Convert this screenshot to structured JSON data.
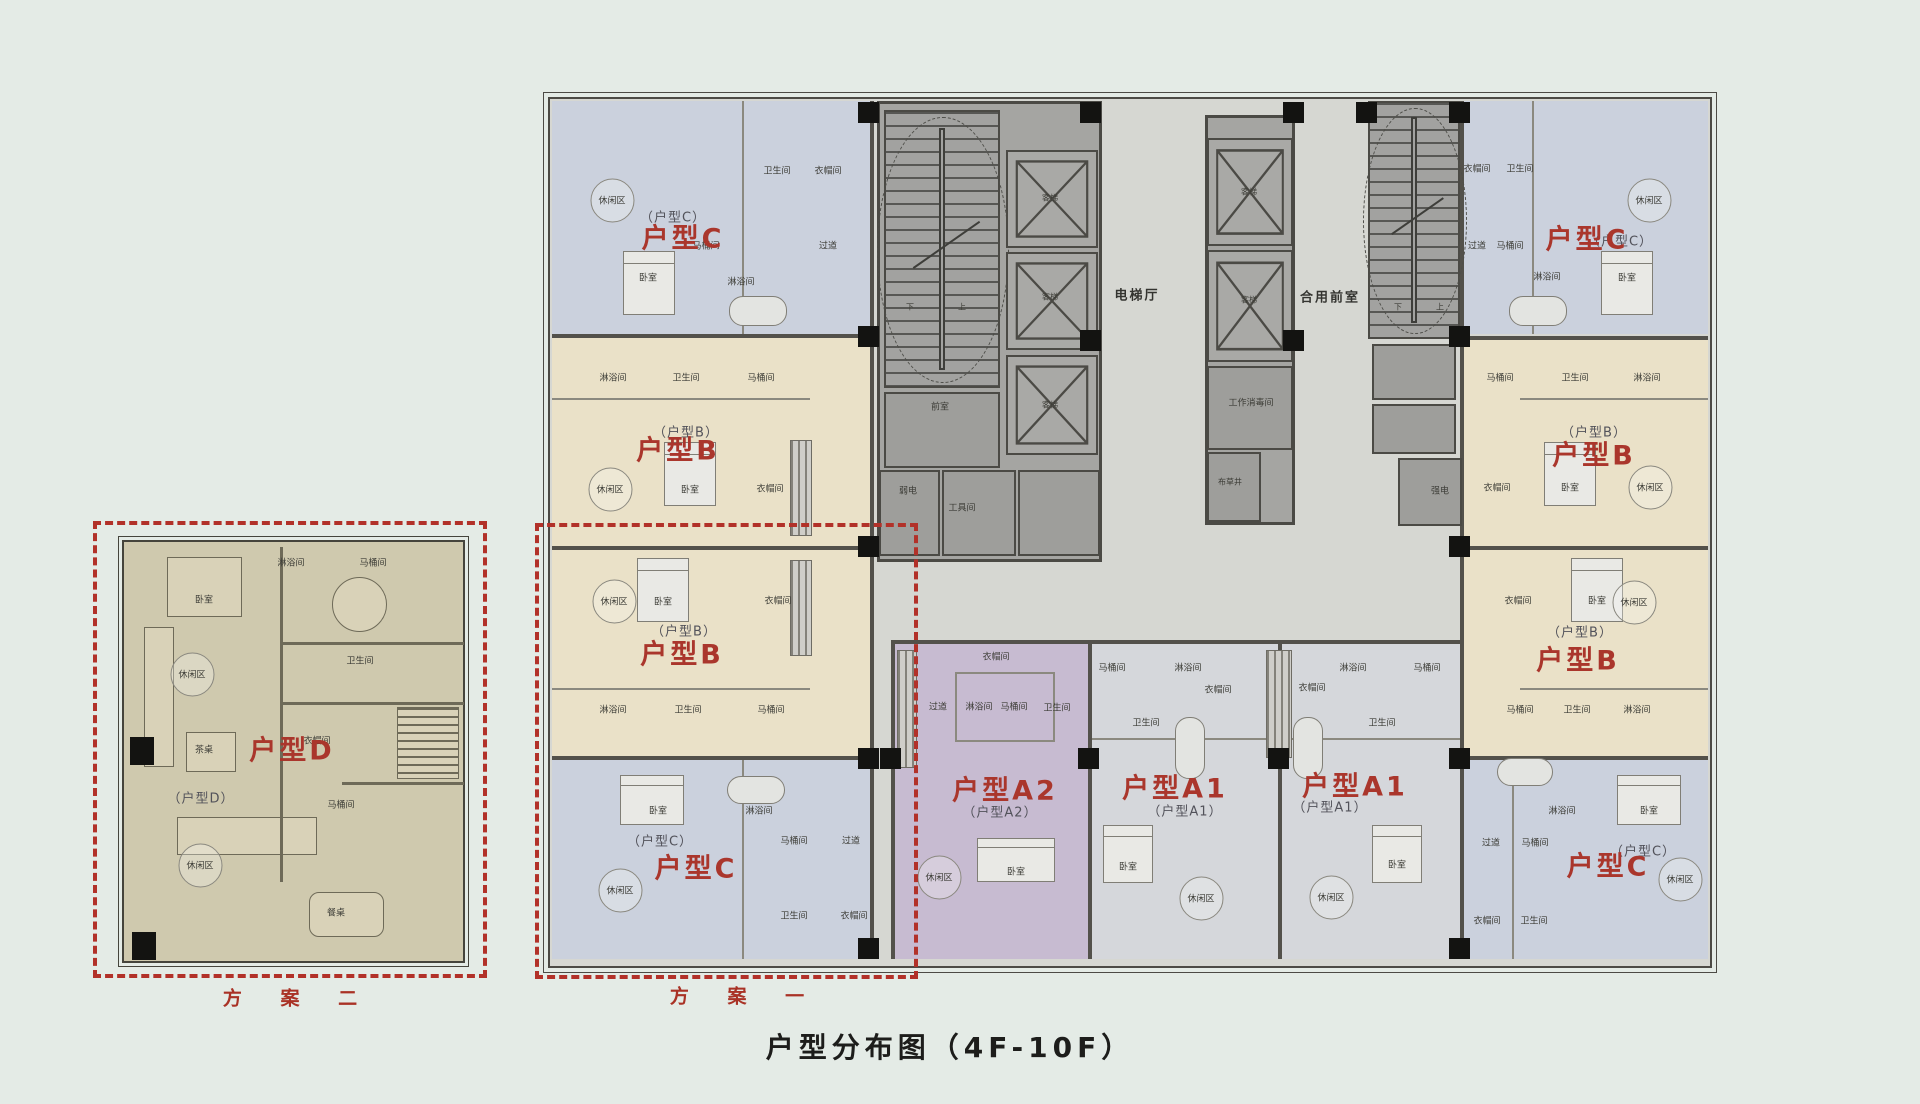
{
  "title": "户型分布图（4F-10F）",
  "schemes": {
    "one": "方 案 一",
    "two": "方 案 二"
  },
  "colors": {
    "canvas_bg": "#e4ebe6",
    "plan_bg": "#d6d7d2",
    "unit_c": "#cbd1dd",
    "unit_b": "#eae1c8",
    "unit_a1": "#d5d7db",
    "unit_a2": "#c7bbd1",
    "unit_d_bg": "#cfc9ae",
    "core_gray": "#a5a5a2",
    "wall": "#53514b",
    "label_red": "#aa362c",
    "dash_red": "#b23129",
    "title_black": "#1d1d1b"
  },
  "unit_labels": [
    {
      "t": "户型C",
      "x": 683,
      "y": 236
    },
    {
      "t": "户型B",
      "x": 678,
      "y": 448
    },
    {
      "t": "户型B",
      "x": 682,
      "y": 652
    },
    {
      "t": "户型C",
      "x": 696,
      "y": 866
    },
    {
      "t": "户型C",
      "x": 1587,
      "y": 237
    },
    {
      "t": "户型B",
      "x": 1594,
      "y": 453
    },
    {
      "t": "户型B",
      "x": 1578,
      "y": 658
    },
    {
      "t": "户型C",
      "x": 1608,
      "y": 864
    },
    {
      "t": "户型A2",
      "x": 1005,
      "y": 788
    },
    {
      "t": "户型A1",
      "x": 1175,
      "y": 786
    },
    {
      "t": "户型A1",
      "x": 1355,
      "y": 784
    },
    {
      "t": "户型D",
      "x": 292,
      "y": 748
    }
  ],
  "room_labels": [
    {
      "t": "（户型C）",
      "x": 673,
      "y": 216,
      "cls": "sub"
    },
    {
      "t": "（户型B）",
      "x": 686,
      "y": 431,
      "cls": "sub"
    },
    {
      "t": "（户型B）",
      "x": 684,
      "y": 630,
      "cls": "sub"
    },
    {
      "t": "（户型C）",
      "x": 660,
      "y": 840,
      "cls": "sub"
    },
    {
      "t": "（户型C）",
      "x": 1620,
      "y": 240,
      "cls": "sub"
    },
    {
      "t": "（户型B）",
      "x": 1594,
      "y": 431,
      "cls": "sub"
    },
    {
      "t": "（户型B）",
      "x": 1580,
      "y": 631,
      "cls": "sub"
    },
    {
      "t": "（户型C）",
      "x": 1643,
      "y": 850,
      "cls": "sub"
    },
    {
      "t": "（户型A2）",
      "x": 1000,
      "y": 811,
      "cls": "sub"
    },
    {
      "t": "（户型A1）",
      "x": 1185,
      "y": 810,
      "cls": "sub"
    },
    {
      "t": "（户型A1）",
      "x": 1330,
      "y": 806,
      "cls": "sub"
    },
    {
      "t": "（户型D）",
      "x": 201,
      "y": 797,
      "cls": "sub"
    },
    {
      "t": "休闲区",
      "x": 612,
      "y": 200,
      "cls": "lz"
    },
    {
      "t": "卫生间",
      "x": 777,
      "y": 170
    },
    {
      "t": "衣帽间",
      "x": 828,
      "y": 170
    },
    {
      "t": "马桶间",
      "x": 706,
      "y": 245
    },
    {
      "t": "过道",
      "x": 828,
      "y": 245
    },
    {
      "t": "淋浴间",
      "x": 741,
      "y": 281
    },
    {
      "t": "卧室",
      "x": 648,
      "y": 277
    },
    {
      "t": "淋浴间",
      "x": 613,
      "y": 377
    },
    {
      "t": "卫生间",
      "x": 686,
      "y": 377
    },
    {
      "t": "马桶间",
      "x": 761,
      "y": 377
    },
    {
      "t": "休闲区",
      "x": 610,
      "y": 489,
      "cls": "lz"
    },
    {
      "t": "卧室",
      "x": 690,
      "y": 489
    },
    {
      "t": "衣帽间",
      "x": 770,
      "y": 488
    },
    {
      "t": "休闲区",
      "x": 614,
      "y": 601,
      "cls": "lz"
    },
    {
      "t": "卧室",
      "x": 663,
      "y": 601
    },
    {
      "t": "衣帽间",
      "x": 778,
      "y": 600
    },
    {
      "t": "淋浴间",
      "x": 613,
      "y": 709
    },
    {
      "t": "卫生间",
      "x": 688,
      "y": 709
    },
    {
      "t": "马桶间",
      "x": 771,
      "y": 709
    },
    {
      "t": "卧室",
      "x": 658,
      "y": 810
    },
    {
      "t": "淋浴间",
      "x": 759,
      "y": 810
    },
    {
      "t": "马桶间",
      "x": 794,
      "y": 840
    },
    {
      "t": "过道",
      "x": 851,
      "y": 840
    },
    {
      "t": "卫生间",
      "x": 794,
      "y": 915
    },
    {
      "t": "衣帽间",
      "x": 854,
      "y": 915
    },
    {
      "t": "休闲区",
      "x": 620,
      "y": 890,
      "cls": "lz"
    },
    {
      "t": "衣帽间",
      "x": 1477,
      "y": 168
    },
    {
      "t": "卫生间",
      "x": 1520,
      "y": 168
    },
    {
      "t": "过道",
      "x": 1477,
      "y": 245
    },
    {
      "t": "马桶间",
      "x": 1510,
      "y": 245
    },
    {
      "t": "淋浴间",
      "x": 1547,
      "y": 276
    },
    {
      "t": "卧室",
      "x": 1627,
      "y": 277
    },
    {
      "t": "休闲区",
      "x": 1649,
      "y": 200,
      "cls": "lz"
    },
    {
      "t": "马桶间",
      "x": 1500,
      "y": 377
    },
    {
      "t": "卫生间",
      "x": 1575,
      "y": 377
    },
    {
      "t": "淋浴间",
      "x": 1647,
      "y": 377
    },
    {
      "t": "衣帽间",
      "x": 1497,
      "y": 487
    },
    {
      "t": "卧室",
      "x": 1570,
      "y": 487
    },
    {
      "t": "休闲区",
      "x": 1650,
      "y": 487,
      "cls": "lz"
    },
    {
      "t": "衣帽间",
      "x": 1518,
      "y": 600
    },
    {
      "t": "卧室",
      "x": 1597,
      "y": 600
    },
    {
      "t": "休闲区",
      "x": 1634,
      "y": 602,
      "cls": "lz"
    },
    {
      "t": "马桶间",
      "x": 1520,
      "y": 709
    },
    {
      "t": "卫生间",
      "x": 1577,
      "y": 709
    },
    {
      "t": "淋浴间",
      "x": 1637,
      "y": 709
    },
    {
      "t": "淋浴间",
      "x": 1562,
      "y": 810
    },
    {
      "t": "卧室",
      "x": 1649,
      "y": 810
    },
    {
      "t": "过道",
      "x": 1491,
      "y": 842
    },
    {
      "t": "马桶间",
      "x": 1535,
      "y": 842
    },
    {
      "t": "衣帽间",
      "x": 1487,
      "y": 920
    },
    {
      "t": "卫生间",
      "x": 1534,
      "y": 920
    },
    {
      "t": "休闲区",
      "x": 1680,
      "y": 879,
      "cls": "lz"
    },
    {
      "t": "衣帽间",
      "x": 996,
      "y": 656
    },
    {
      "t": "过道",
      "x": 938,
      "y": 706
    },
    {
      "t": "淋浴间",
      "x": 979,
      "y": 706
    },
    {
      "t": "马桶间",
      "x": 1014,
      "y": 706
    },
    {
      "t": "卫生间",
      "x": 1057,
      "y": 707
    },
    {
      "t": "休闲区",
      "x": 939,
      "y": 877,
      "cls": "lz"
    },
    {
      "t": "卧室",
      "x": 1016,
      "y": 871
    },
    {
      "t": "马桶间",
      "x": 1112,
      "y": 667
    },
    {
      "t": "淋浴间",
      "x": 1188,
      "y": 667
    },
    {
      "t": "卫生间",
      "x": 1146,
      "y": 722
    },
    {
      "t": "衣帽间",
      "x": 1218,
      "y": 689
    },
    {
      "t": "卧室",
      "x": 1128,
      "y": 866
    },
    {
      "t": "休闲区",
      "x": 1201,
      "y": 898,
      "cls": "lz"
    },
    {
      "t": "衣帽间",
      "x": 1312,
      "y": 687
    },
    {
      "t": "淋浴间",
      "x": 1353,
      "y": 667
    },
    {
      "t": "马桶间",
      "x": 1427,
      "y": 667
    },
    {
      "t": "卫生间",
      "x": 1382,
      "y": 722
    },
    {
      "t": "卧室",
      "x": 1397,
      "y": 864
    },
    {
      "t": "休闲区",
      "x": 1331,
      "y": 897,
      "cls": "lz"
    },
    {
      "t": "电梯厅",
      "x": 1137,
      "y": 294,
      "cls": "hall"
    },
    {
      "t": "合用前室",
      "x": 1330,
      "y": 296,
      "cls": "hall"
    },
    {
      "t": "前室",
      "x": 940,
      "y": 406
    },
    {
      "t": "客梯",
      "x": 1050,
      "y": 198,
      "s": 8
    },
    {
      "t": "客梯",
      "x": 1050,
      "y": 297,
      "s": 8
    },
    {
      "t": "客梯",
      "x": 1050,
      "y": 405,
      "s": 8
    },
    {
      "t": "客梯",
      "x": 1249,
      "y": 192,
      "s": 8
    },
    {
      "t": "客梯",
      "x": 1249,
      "y": 300,
      "s": 8
    },
    {
      "t": "工作消毒间",
      "x": 1251,
      "y": 402
    },
    {
      "t": "布草井",
      "x": 1230,
      "y": 482,
      "s": 8
    },
    {
      "t": "弱电",
      "x": 908,
      "y": 490
    },
    {
      "t": "工具间",
      "x": 962,
      "y": 507
    },
    {
      "t": "强电",
      "x": 1440,
      "y": 490
    },
    {
      "t": "下",
      "x": 910,
      "y": 307,
      "s": 8
    },
    {
      "t": "上",
      "x": 962,
      "y": 307,
      "s": 8
    },
    {
      "t": "下",
      "x": 1398,
      "y": 307,
      "s": 8
    },
    {
      "t": "上",
      "x": 1440,
      "y": 307,
      "s": 8
    },
    {
      "t": "卧室",
      "x": 204,
      "y": 599
    },
    {
      "t": "休闲区",
      "x": 192,
      "y": 674,
      "cls": "lz"
    },
    {
      "t": "茶桌",
      "x": 204,
      "y": 749
    },
    {
      "t": "淋浴间",
      "x": 291,
      "y": 562
    },
    {
      "t": "马桶间",
      "x": 373,
      "y": 562
    },
    {
      "t": "卫生间",
      "x": 360,
      "y": 660
    },
    {
      "t": "衣帽间",
      "x": 317,
      "y": 740
    },
    {
      "t": "马桶间",
      "x": 341,
      "y": 804
    },
    {
      "t": "休闲区",
      "x": 200,
      "y": 865,
      "cls": "lz"
    },
    {
      "t": "餐桌",
      "x": 336,
      "y": 912
    }
  ]
}
